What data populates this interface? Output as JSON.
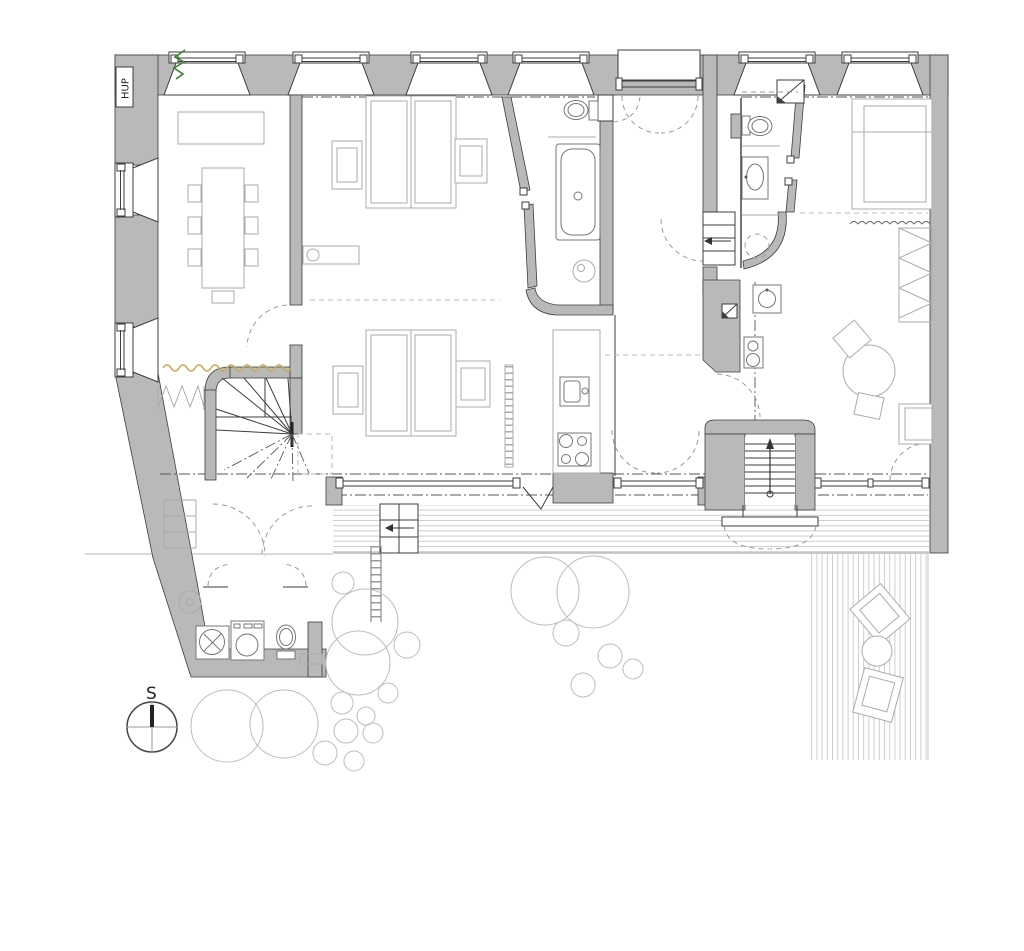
{
  "document": {
    "type": "architectural floor plan",
    "view": "top-down apartment plan with garden terrace"
  },
  "labels": {
    "gas_meter": "HUP",
    "compass_north": "S"
  },
  "colors": {
    "background": "#ffffff",
    "wall_fill": "#b9b9b9",
    "line_dark": "#3d3d3d",
    "line_mid": "#8a8a8a",
    "line_light": "#ababab",
    "tree_line": "#bdbdbd",
    "deck_line": "#c9c9c9",
    "accent_green": "#3e7c35",
    "accent_tan": "#c2ab5e",
    "needle_dark": "#222222"
  },
  "counts": {
    "facade_windows": 6,
    "side_windows": 2,
    "trees": 19,
    "bathrooms": 2,
    "beds": 3
  }
}
